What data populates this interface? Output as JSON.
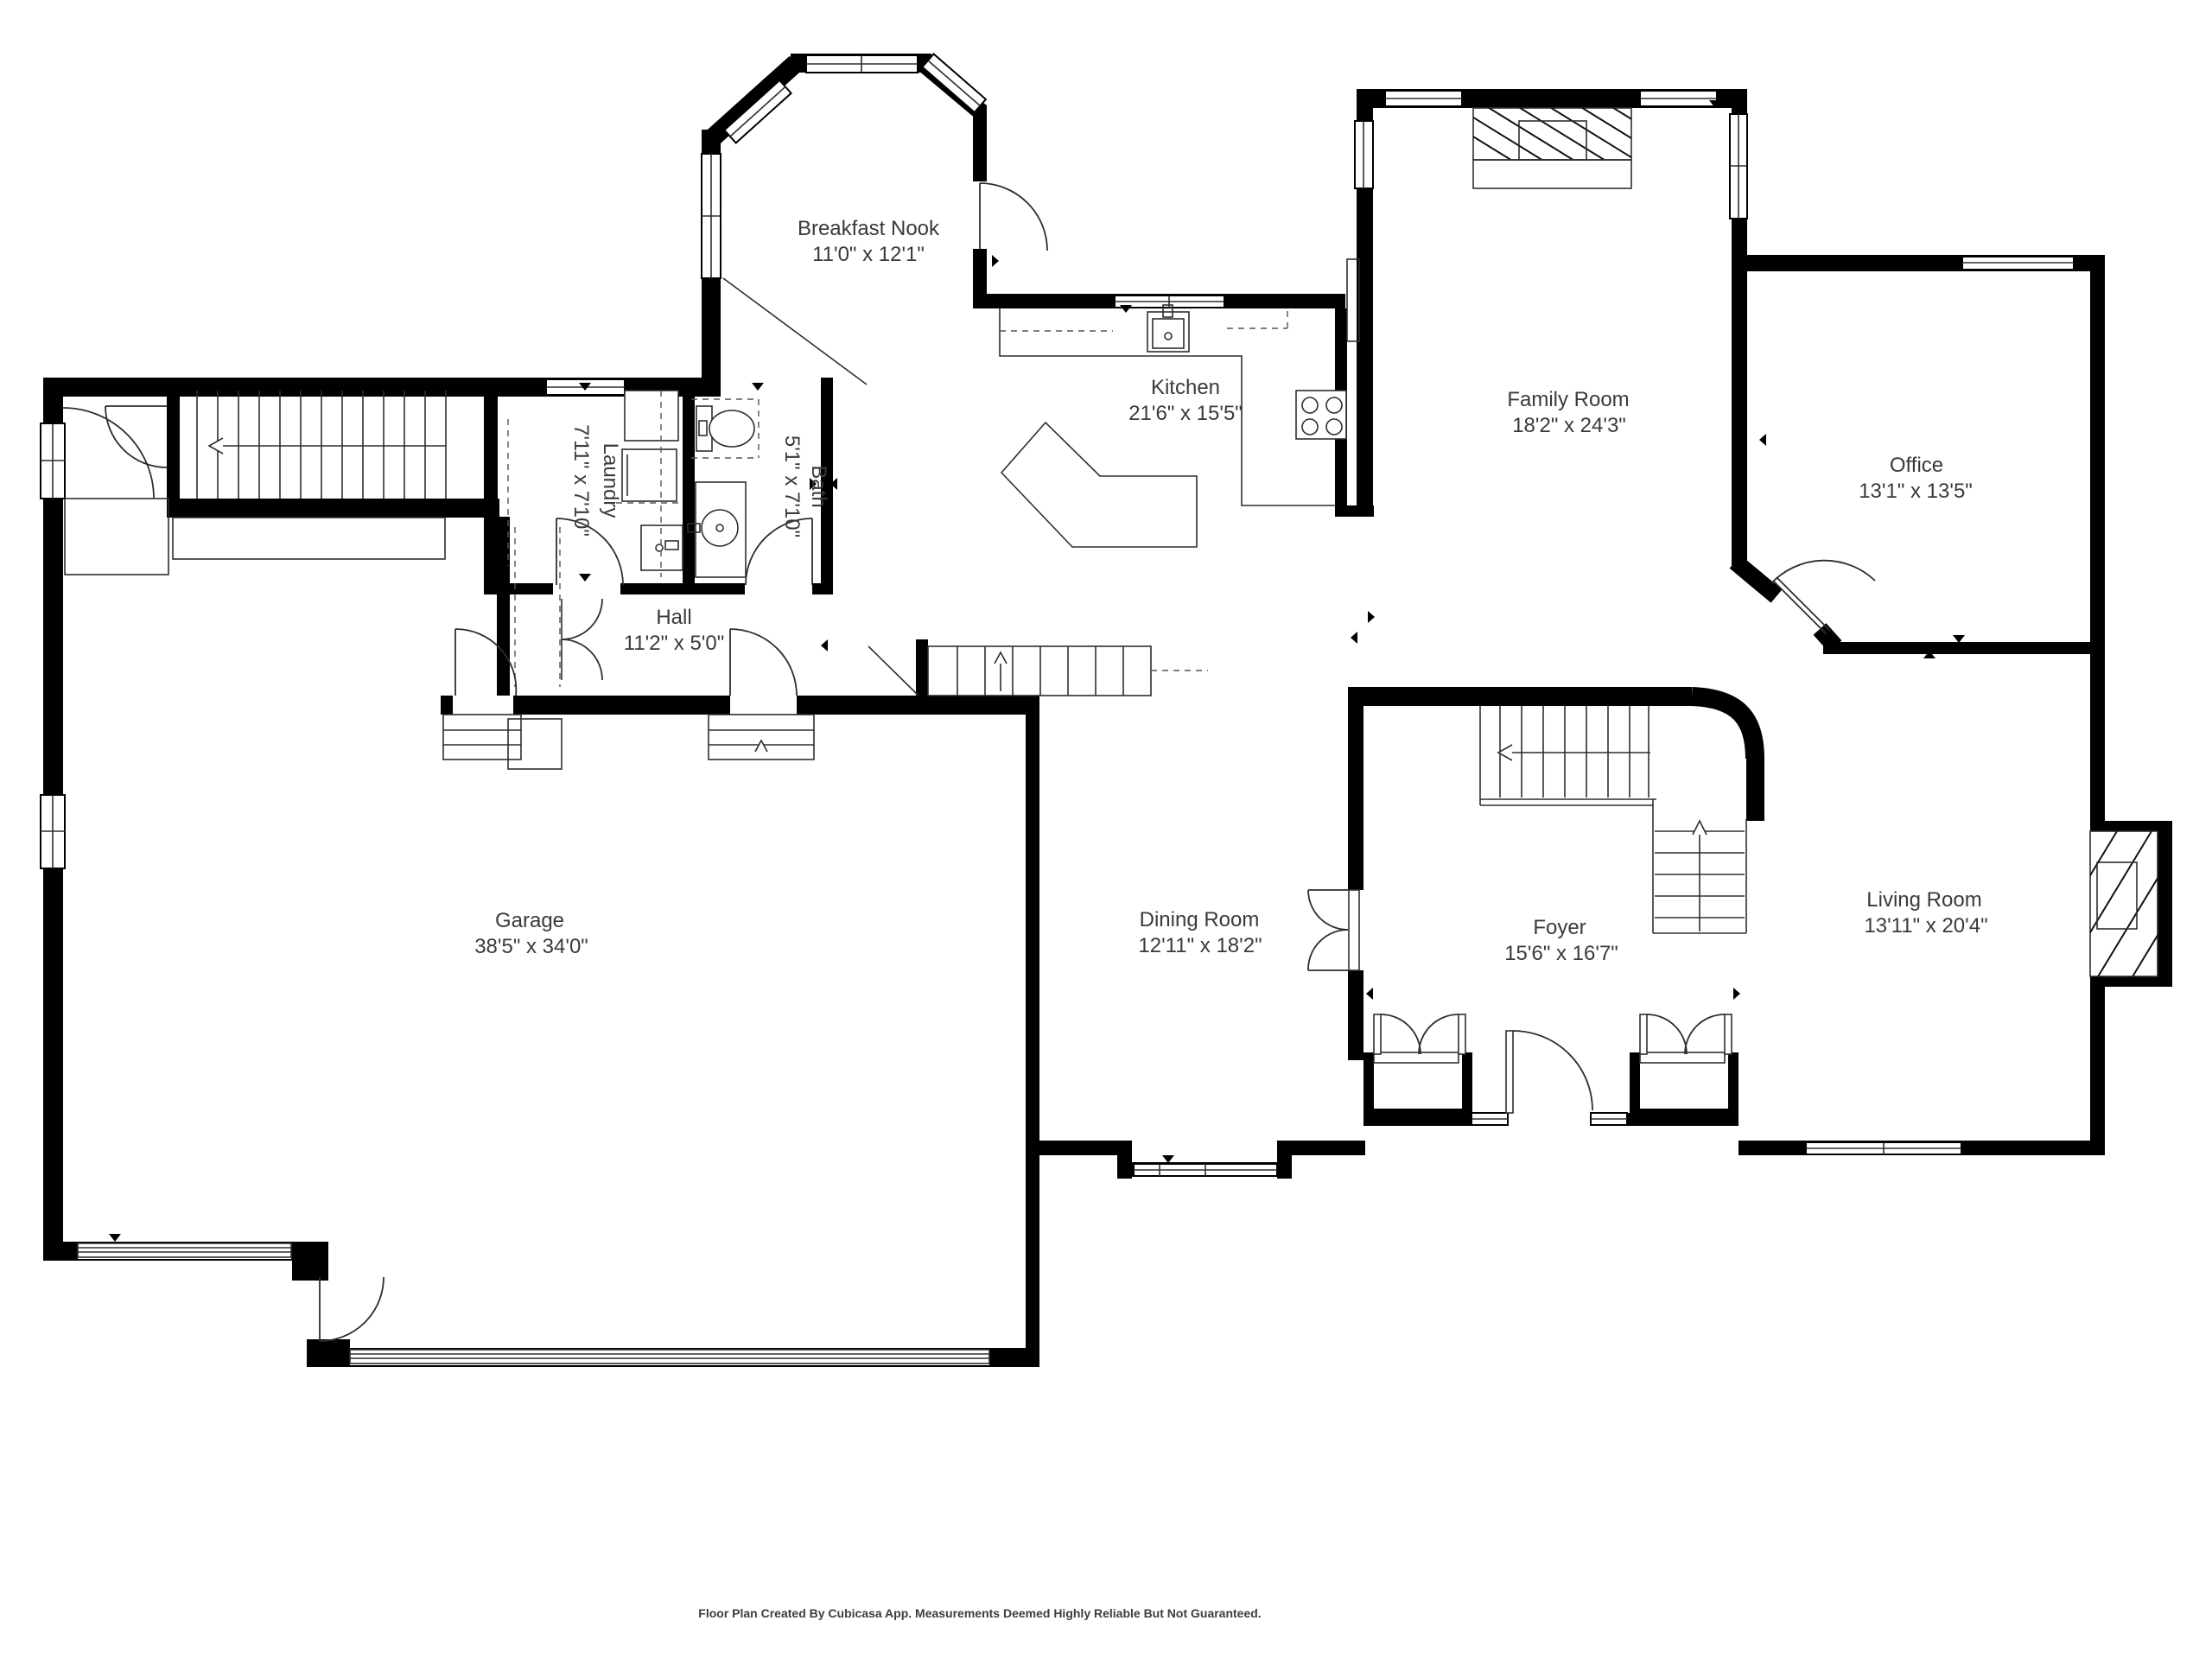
{
  "plan": {
    "footer": "Floor Plan Created By Cubicasa App. Measurements Deemed Highly Reliable But Not Guaranteed."
  },
  "rooms": [
    {
      "name": "Breakfast Nook",
      "dims": "11'0\" x 12'1\""
    },
    {
      "name": "Kitchen",
      "dims": "21'6\" x 15'5\""
    },
    {
      "name": "Family Room",
      "dims": "18'2\" x 24'3\""
    },
    {
      "name": "Office",
      "dims": "13'1\" x 13'5\""
    },
    {
      "name": "Laundry",
      "dims": "7'11\" x 7'10\""
    },
    {
      "name": "Bath",
      "dims": "5'1\" x 7'10\""
    },
    {
      "name": "Hall",
      "dims": "11'2\" x 5'0\""
    },
    {
      "name": "Garage",
      "dims": "38'5\" x 34'0\""
    },
    {
      "name": "Dining Room",
      "dims": "12'11\" x 18'2\""
    },
    {
      "name": "Foyer",
      "dims": "15'6\" x 16'7\""
    },
    {
      "name": "Living Room",
      "dims": "13'11\" x 20'4\""
    }
  ],
  "colors": {
    "wall": "#000000",
    "line": "#2e2e2e",
    "label": "#3a3a3a",
    "background": "#ffffff"
  }
}
